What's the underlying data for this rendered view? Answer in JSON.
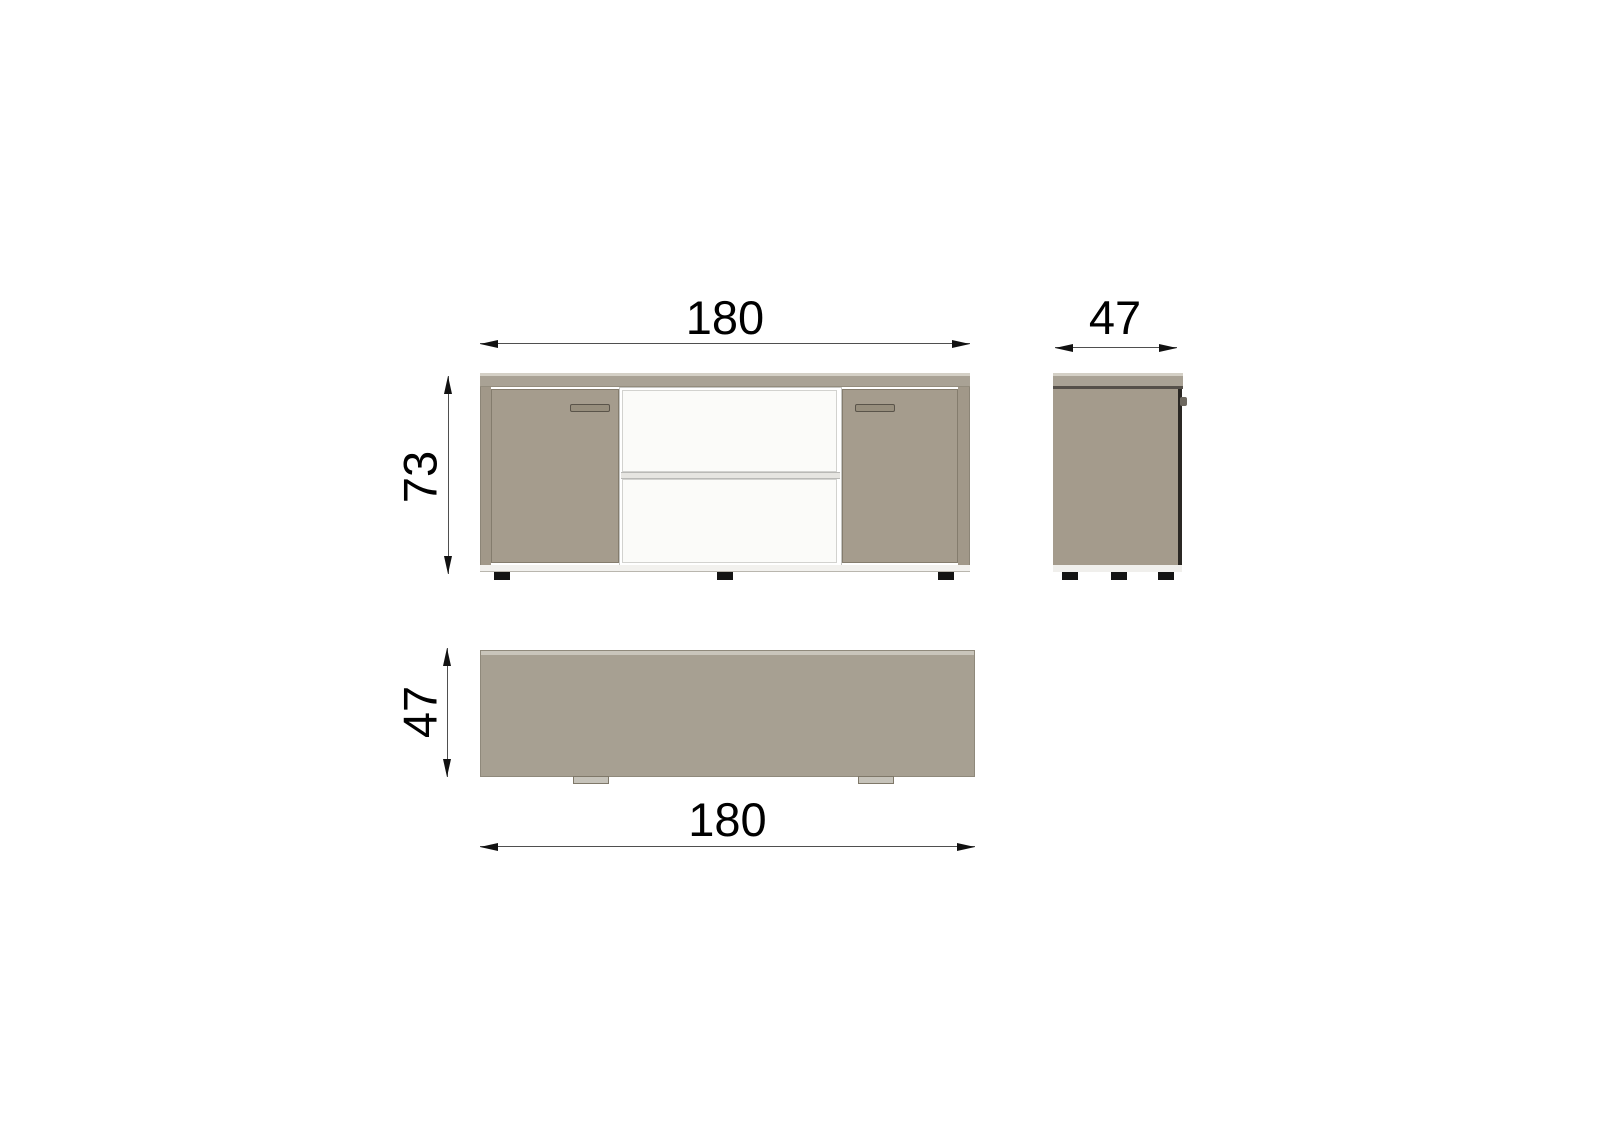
{
  "diagram": {
    "type": "furniture-dimension-drawing",
    "views": [
      "front",
      "side",
      "top"
    ],
    "dimensions": {
      "front_width": "180",
      "front_height": "73",
      "side_depth": "47",
      "top_depth": "47",
      "top_width": "180"
    },
    "colors": {
      "background": "#ffffff",
      "top_board": "#a9a295",
      "top_board_highlight": "#d4d0c6",
      "door": "#a59c8d",
      "side_body": "#a49b8c",
      "shelf_white": "#fbfbf9",
      "bottom_strip": "#f2f1ee",
      "foot": "#141414",
      "dimension_line": "#4f4f4f",
      "label_text": "#000000"
    }
  }
}
